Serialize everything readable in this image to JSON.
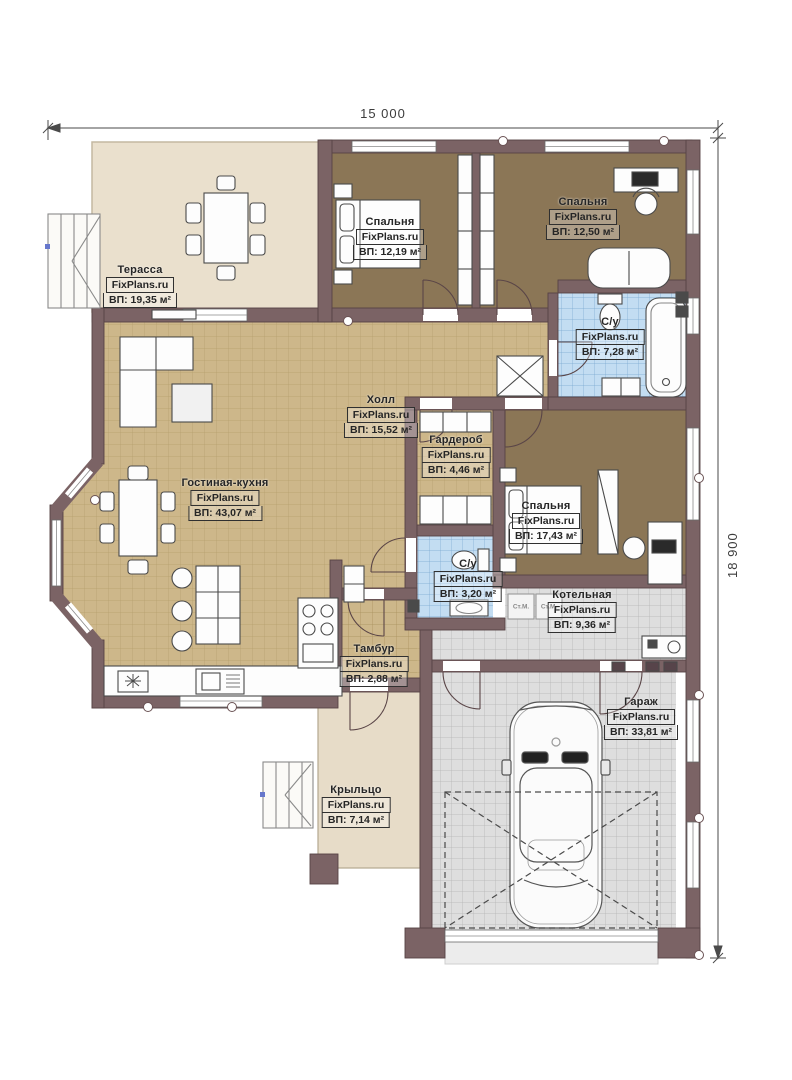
{
  "meta": {
    "drawing_type": "floor plan",
    "brand": "FixPlans.ru"
  },
  "dimensions": {
    "width": "15 000",
    "height": "18 900"
  },
  "rooms": [
    {
      "key": "terrace",
      "name": "Терасса",
      "brand": "FixPlans.ru",
      "area": "ВП: 19,35 м²"
    },
    {
      "key": "bedroom-1",
      "name": "Спальня",
      "brand": "FixPlans.ru",
      "area": "ВП: 12,19 м²"
    },
    {
      "key": "bedroom-2",
      "name": "Спальня",
      "brand": "FixPlans.ru",
      "area": "ВП: 12,50 м²"
    },
    {
      "key": "bathroom-1",
      "name": "С/у",
      "brand": "FixPlans.ru",
      "area": "ВП: 7,28 м²"
    },
    {
      "key": "hall",
      "name": "Холл",
      "brand": "FixPlans.ru",
      "area": "ВП: 15,52 м²"
    },
    {
      "key": "wardrobe",
      "name": "Гардероб",
      "brand": "FixPlans.ru",
      "area": "ВП: 4,46 м²"
    },
    {
      "key": "living-kitchen",
      "name": "Гостиная-кухня",
      "brand": "FixPlans.ru",
      "area": "ВП: 43,07 м²"
    },
    {
      "key": "bedroom-3",
      "name": "Спальня",
      "brand": "FixPlans.ru",
      "area": "ВП: 17,43 м²"
    },
    {
      "key": "bathroom-2",
      "name": "С/у",
      "brand": "FixPlans.ru",
      "area": "ВП: 3,20 м²"
    },
    {
      "key": "boiler-room",
      "name": "Котельная",
      "brand": "FixPlans.ru",
      "area": "ВП: 9,36 м²"
    },
    {
      "key": "vestibule",
      "name": "Тамбур",
      "brand": "FixPlans.ru",
      "area": "ВП: 2,88 м²"
    },
    {
      "key": "garage",
      "name": "Гараж",
      "brand": "FixPlans.ru",
      "area": "ВП: 33,81 м²"
    },
    {
      "key": "porch",
      "name": "Крыльцо",
      "brand": "FixPlans.ru",
      "area": "ВП: 7,14 м²"
    }
  ],
  "appliances": {
    "washer_label": "Ст.М."
  },
  "colors": {
    "wall": "#7b6365",
    "floor_tile_tan": "#cdb78a",
    "floor_wood_brown": "#8b7656",
    "tile_blue": "#c3ddf2",
    "tile_gray": "#dedede",
    "terrace": "#eae0cd",
    "porch": "#e7dcc8"
  }
}
